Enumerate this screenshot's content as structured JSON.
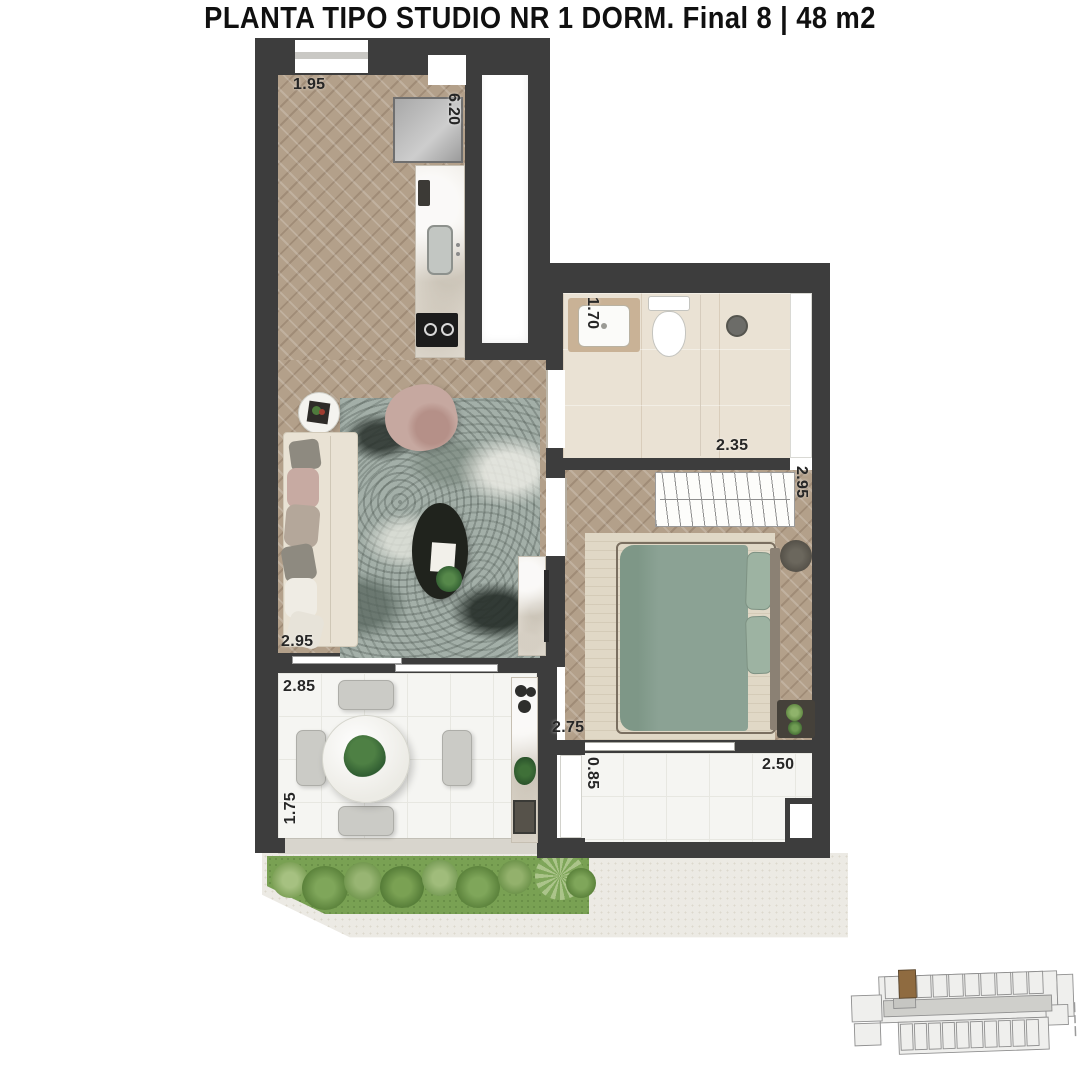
{
  "caption": {
    "title": "PLANTA TIPO STUDIO NR 1 DORM. Final 8 | 48 m2"
  },
  "dimensions": {
    "entry_width": "1.95",
    "kitchen_run": "6.20",
    "bathroom_width": "1.70",
    "bathroom_length": "2.35",
    "closet_length": "2.95",
    "living_width": "2.95",
    "terrace_width": "2.85",
    "terrace_depth": "1.75",
    "bedroom_width": "2.75",
    "bedroom_terrace_depth": "0.85",
    "bedroom_terrace_width": "2.50"
  },
  "colors": {
    "wall": "#3d3d3d",
    "wood_floor": "#b3a08a",
    "bath_floor": "#eae2d4",
    "terrace_floor": "#f5f5f2",
    "rug": "#a3afa8",
    "bed": "#8ba294",
    "garden": "#79a153",
    "keyplan_highlight": "#8f6b40"
  }
}
